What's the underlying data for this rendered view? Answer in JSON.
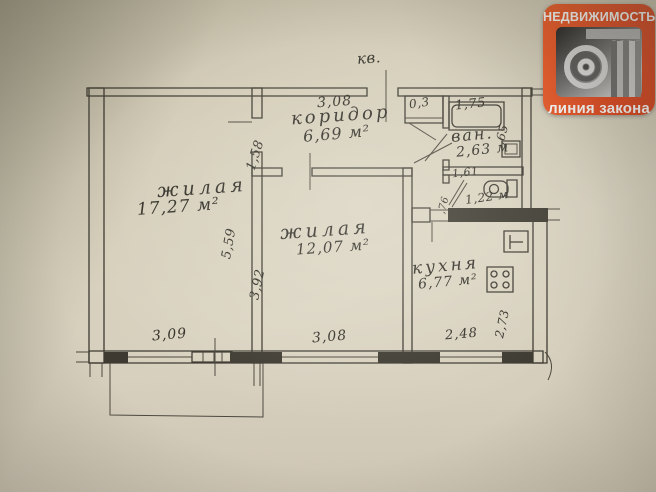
{
  "colors": {
    "paper": "#d5ceba",
    "ink": "#3c3930",
    "logo_orange": "#e8481c"
  },
  "logo": {
    "top_text": "НЕДВИЖИМОСТЬ",
    "bottom_text": "линия закона"
  },
  "plan": {
    "entrance_label": "кв.",
    "rooms": {
      "room1": {
        "name": "жилая",
        "area": "17,27 м²",
        "width": "3,09",
        "depth": "5,59"
      },
      "room2": {
        "name": "жилая",
        "area": "12,07 м²",
        "width": "3,08",
        "depth": "3,92"
      },
      "corridor": {
        "name": "коридор",
        "area": "6,69 м²",
        "width": "3,08",
        "depth": "1,58"
      },
      "kitchen": {
        "name": "кухня",
        "area": "6,77 м²",
        "width": "2,48",
        "depth": "2,73"
      },
      "bathroom": {
        "name": "ван.",
        "area": "2,63 м",
        "tub_length": "1,75",
        "tub_width": ",65"
      },
      "wc": {
        "area": "1,22 м",
        "length": "1,61",
        "depth": ",76"
      },
      "closet": {
        "area": "0,3"
      }
    }
  }
}
